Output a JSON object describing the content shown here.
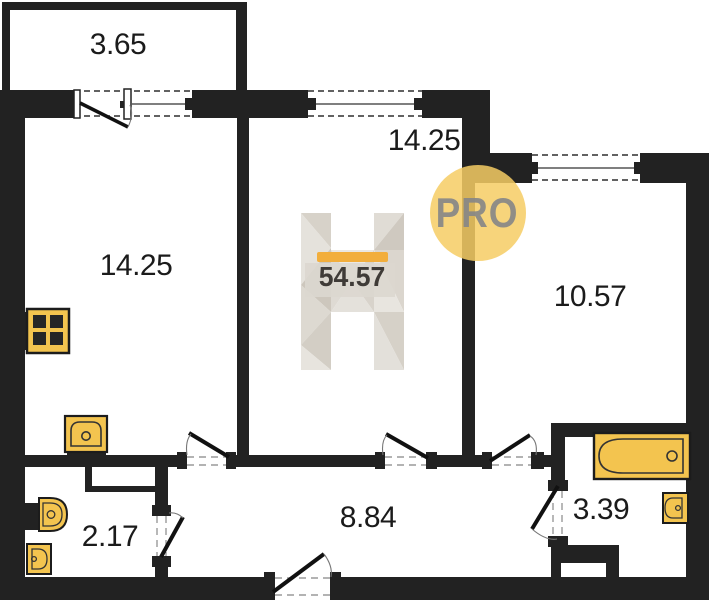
{
  "plan": {
    "rooms": {
      "balcony": {
        "area": "3.65"
      },
      "kitchen_living": {
        "area": "14.25"
      },
      "bedroom": {
        "area": "14.25"
      },
      "bedroom2": {
        "area": "10.57"
      },
      "hallway": {
        "area": "8.84"
      },
      "wc": {
        "area": "2.17"
      },
      "bathroom": {
        "area": "3.39"
      }
    },
    "watermark": {
      "total_area": "54.57",
      "pro_label": "PRO"
    },
    "icons": [
      "stove-icon",
      "kitchen-sink-icon",
      "toilet-icon",
      "wc-sink-icon",
      "bathtub-icon",
      "bathroom-sink-icon",
      "door-swing-icon",
      "window-icon"
    ],
    "colors": {
      "wall": "#222222",
      "fixture_fill": "#F3C44F",
      "accent_bar": "#F2AE3C",
      "pro_circle": "#F6CD64",
      "pro_text": "#878787",
      "label_text": "#1B1B1B"
    }
  }
}
